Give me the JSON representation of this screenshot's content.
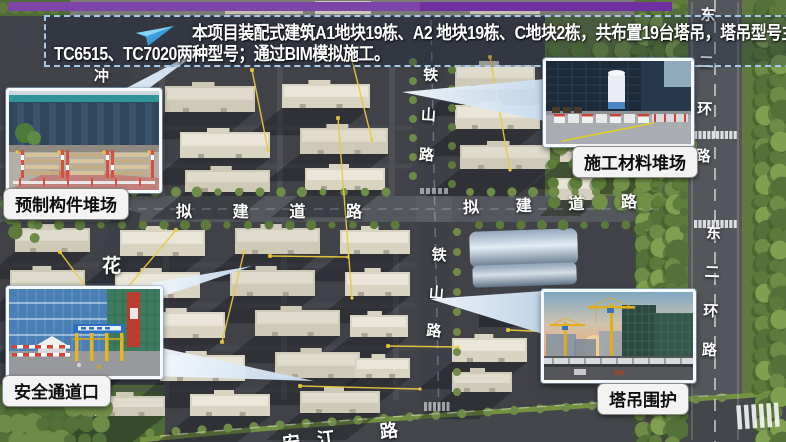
{
  "banner": {
    "line1": "本项目装配式建筑A1地块19栋、A2 地块19栋、C地块2栋，共布置19台塔吊，塔吊型号主要使用",
    "line2": "TC6515、TC7020两种型号；通过BIM模拟施工。",
    "border_color": "#a6c9ea",
    "text_color": "#ffffff",
    "arrow_icon": "paper-plane-icon",
    "arrow_color": "#29abe2"
  },
  "decor": {
    "top_bar_color": "#7030a0",
    "crane_line_color": "#e9c93f",
    "label_bg_color": "#f3f3f3"
  },
  "callouts": {
    "precast": {
      "label": "预制构件堆场"
    },
    "materials": {
      "label": "施工材料堆场"
    },
    "safety": {
      "label": "安全通道口"
    },
    "crane": {
      "label": "塔吊围护"
    }
  },
  "roads": {
    "planned_left": [
      "拟",
      "建",
      "道",
      "路"
    ],
    "planned_right": [
      "拟",
      "建",
      "道",
      "路"
    ],
    "tieshan_top": [
      "铁",
      "山",
      "路"
    ],
    "tieshan_bottom": [
      "铁",
      "山",
      "路"
    ],
    "ring_top": [
      "东",
      "二",
      "环",
      "路"
    ],
    "ring_bottom": [
      "东",
      "二",
      "环",
      "路"
    ],
    "hua": "花",
    "chong": "冲",
    "bottom": [
      "安",
      "江",
      "路"
    ]
  }
}
